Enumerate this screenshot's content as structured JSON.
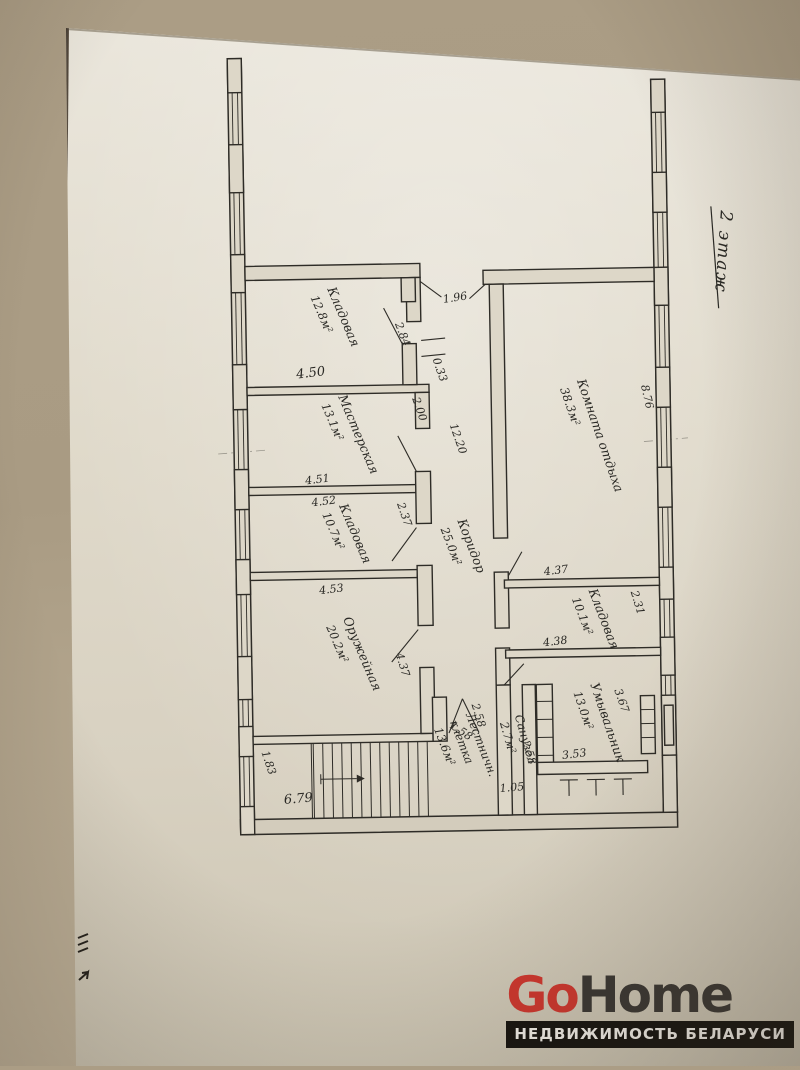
{
  "meta": {
    "floor_label": "2 этаж"
  },
  "rooms": [
    {
      "name": "Кладовая",
      "area": "12.8м²"
    },
    {
      "name": "Мастерская",
      "area": "13.1м²"
    },
    {
      "name": "Кладовая",
      "area": "10.7м²"
    },
    {
      "name": "Оружейная",
      "area": "20.2м²"
    },
    {
      "name": "Коридор",
      "area": "25.0м²"
    },
    {
      "name": "Комната отдыха",
      "area": "38.3м²"
    },
    {
      "name": "Кладовая",
      "area": "10.1м²"
    },
    {
      "name": "Умывальник",
      "area": "13.0м²"
    },
    {
      "name": "Санузел",
      "area": "2.7м²"
    },
    {
      "name": "Лестничн.",
      "name2": "клетка",
      "area": "13.6м²"
    }
  ],
  "dimensions": {
    "corridor_top_door": "1.96",
    "storage1_door_side": "2.84",
    "wall_offset": "0.33",
    "storage1_width": "4.50",
    "workshop_door_side": "2.00",
    "workshop_width": "4.51",
    "storage2_width_top": "4.52",
    "pier_height": "2.37",
    "storage2_width_bottom": "4.53",
    "armory_side": "4.37",
    "corridor_length": "12.20",
    "rest_room_side": "8.76",
    "storage3_width_top": "4.37",
    "storage3_width_bottom": "4.38",
    "storage3_side": "2.31",
    "washroom_side": "3.67",
    "washroom_width": "3.53",
    "toilet_left_side": "2.58",
    "toilet_right_side": "2.58",
    "toilet_width": "1.05",
    "stair_door": "1.58",
    "stair_landing_side": "1.83",
    "stair_width": "6.79"
  },
  "watermark": {
    "brand_go": "Go",
    "brand_home": "Home",
    "tagline": "НЕДВИЖИМОСТЬ БЕЛАРУСИ"
  },
  "colors": {
    "brand_red": "#ce362e",
    "tagline_bar": "#15130f",
    "ink": "#2a2925",
    "paper": "#ddd7c8",
    "background": "#a99b83"
  }
}
